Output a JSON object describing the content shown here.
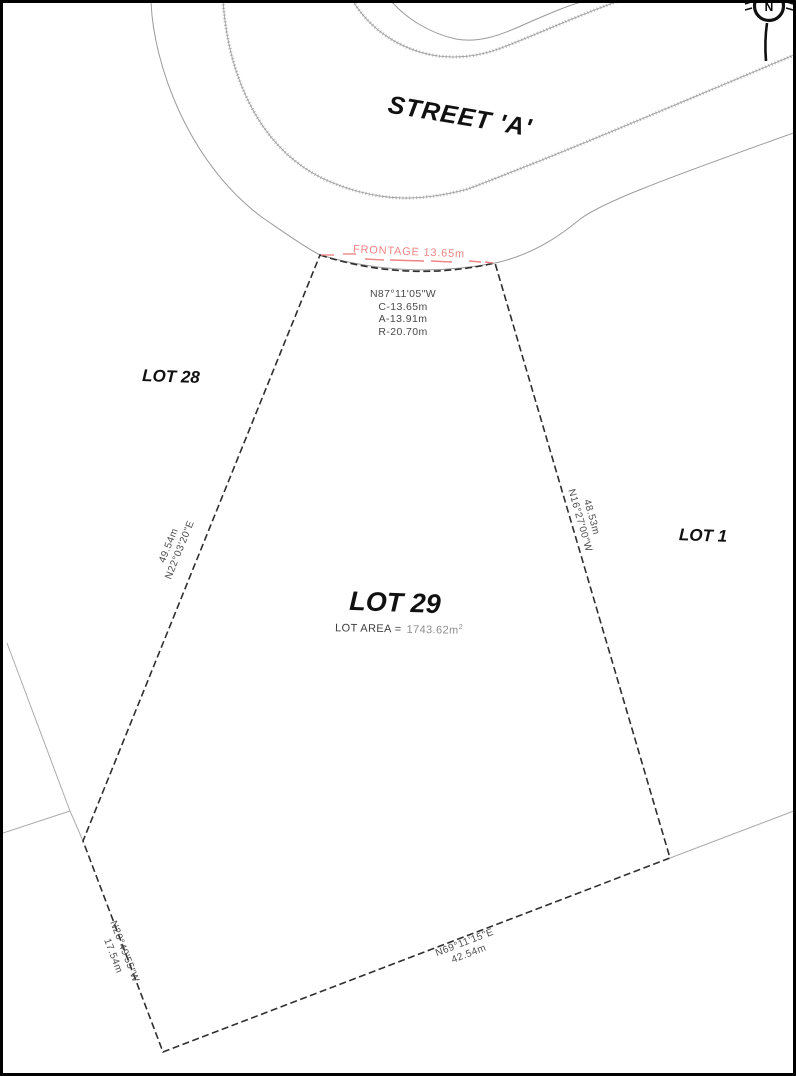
{
  "drawing": {
    "title_note": "Subdivision plan detail",
    "street": {
      "label": "STREET 'A'"
    },
    "north_arrow": {
      "letter": "N"
    },
    "frontage": {
      "label": "FRONTAGE 13.65m",
      "color": "#ee8585"
    },
    "curve_block": {
      "bearing": "N87°11'05\"W",
      "chord": "C-13.65m",
      "arc": "A-13.91m",
      "radius": "R-20.70m"
    },
    "lots": {
      "lot28_label": "LOT 28",
      "lot1_label": "LOT 1",
      "lot29_label": "LOT 29",
      "area_label": "LOT AREA =",
      "area_value": "1743.62m",
      "area_unit_exponent": "2"
    },
    "boundaries": {
      "west": {
        "distance": "49.54m",
        "bearing": "N22°03'20\"E"
      },
      "east": {
        "distance": "48.53m",
        "bearing": "N16°27'00\"W"
      },
      "south": {
        "bearing": "N69°11'15\"E",
        "distance": "42.54m"
      },
      "southwest": {
        "bearing": "N20°49'55\"W",
        "distance": "17.54m"
      }
    },
    "colors": {
      "boundary_dark": "#2f2f2f",
      "road_line_light": "#9a9a9a",
      "parcel_line_faint": "#ababab",
      "frontage_red": "#ee8585"
    }
  }
}
